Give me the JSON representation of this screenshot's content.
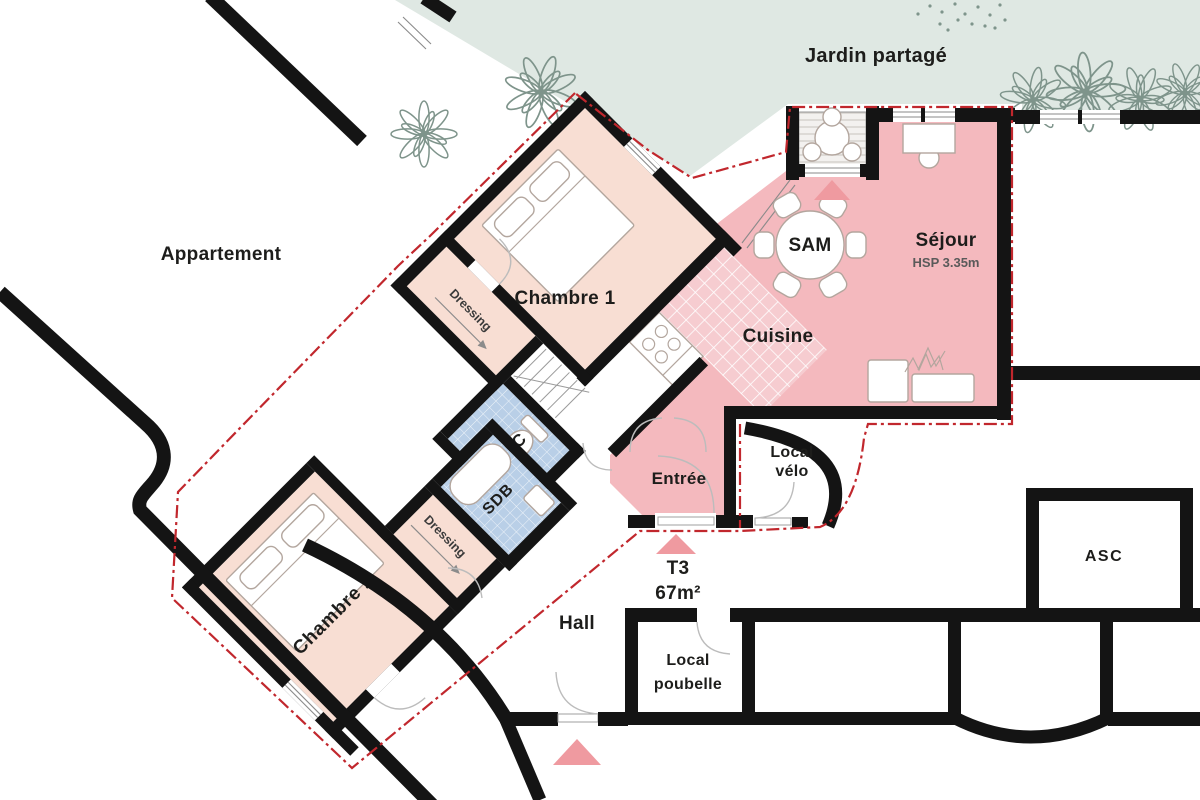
{
  "areas": {
    "garden": "Jardin partagé",
    "neighbor": "Appartement",
    "bedroom1": "Chambre 1",
    "bedroom2": "Chambre 2",
    "dressing1": "Dressing",
    "dressing2": "Dressing",
    "bathroom": "SDB",
    "toilet": "WC",
    "kitchen": "Cuisine",
    "dining": "SAM",
    "living": "Séjour",
    "living_height": "HSP 3.35m",
    "entrance": "Entrée",
    "bike_line1": "Local",
    "bike_line2": "vélo",
    "unit_type": "T3",
    "unit_area": "67m²",
    "hall": "Hall",
    "trash_line1": "Local",
    "trash_line2": "poubelle",
    "elevator": "ASC"
  },
  "colors": {
    "wall": "#141414",
    "garden": "#dfe8e3",
    "plant": "#7e948b",
    "bedroom": "#f8ded3",
    "living": "#f4b9be",
    "tile_pink": "#f6ccd0",
    "wet": "#b9cfe7",
    "boundary": "#c1272d",
    "triangle": "#ef9aa0",
    "fur": "#b3a69e",
    "text": "#1d1d1b",
    "text_muted": "#5a5a5a"
  }
}
